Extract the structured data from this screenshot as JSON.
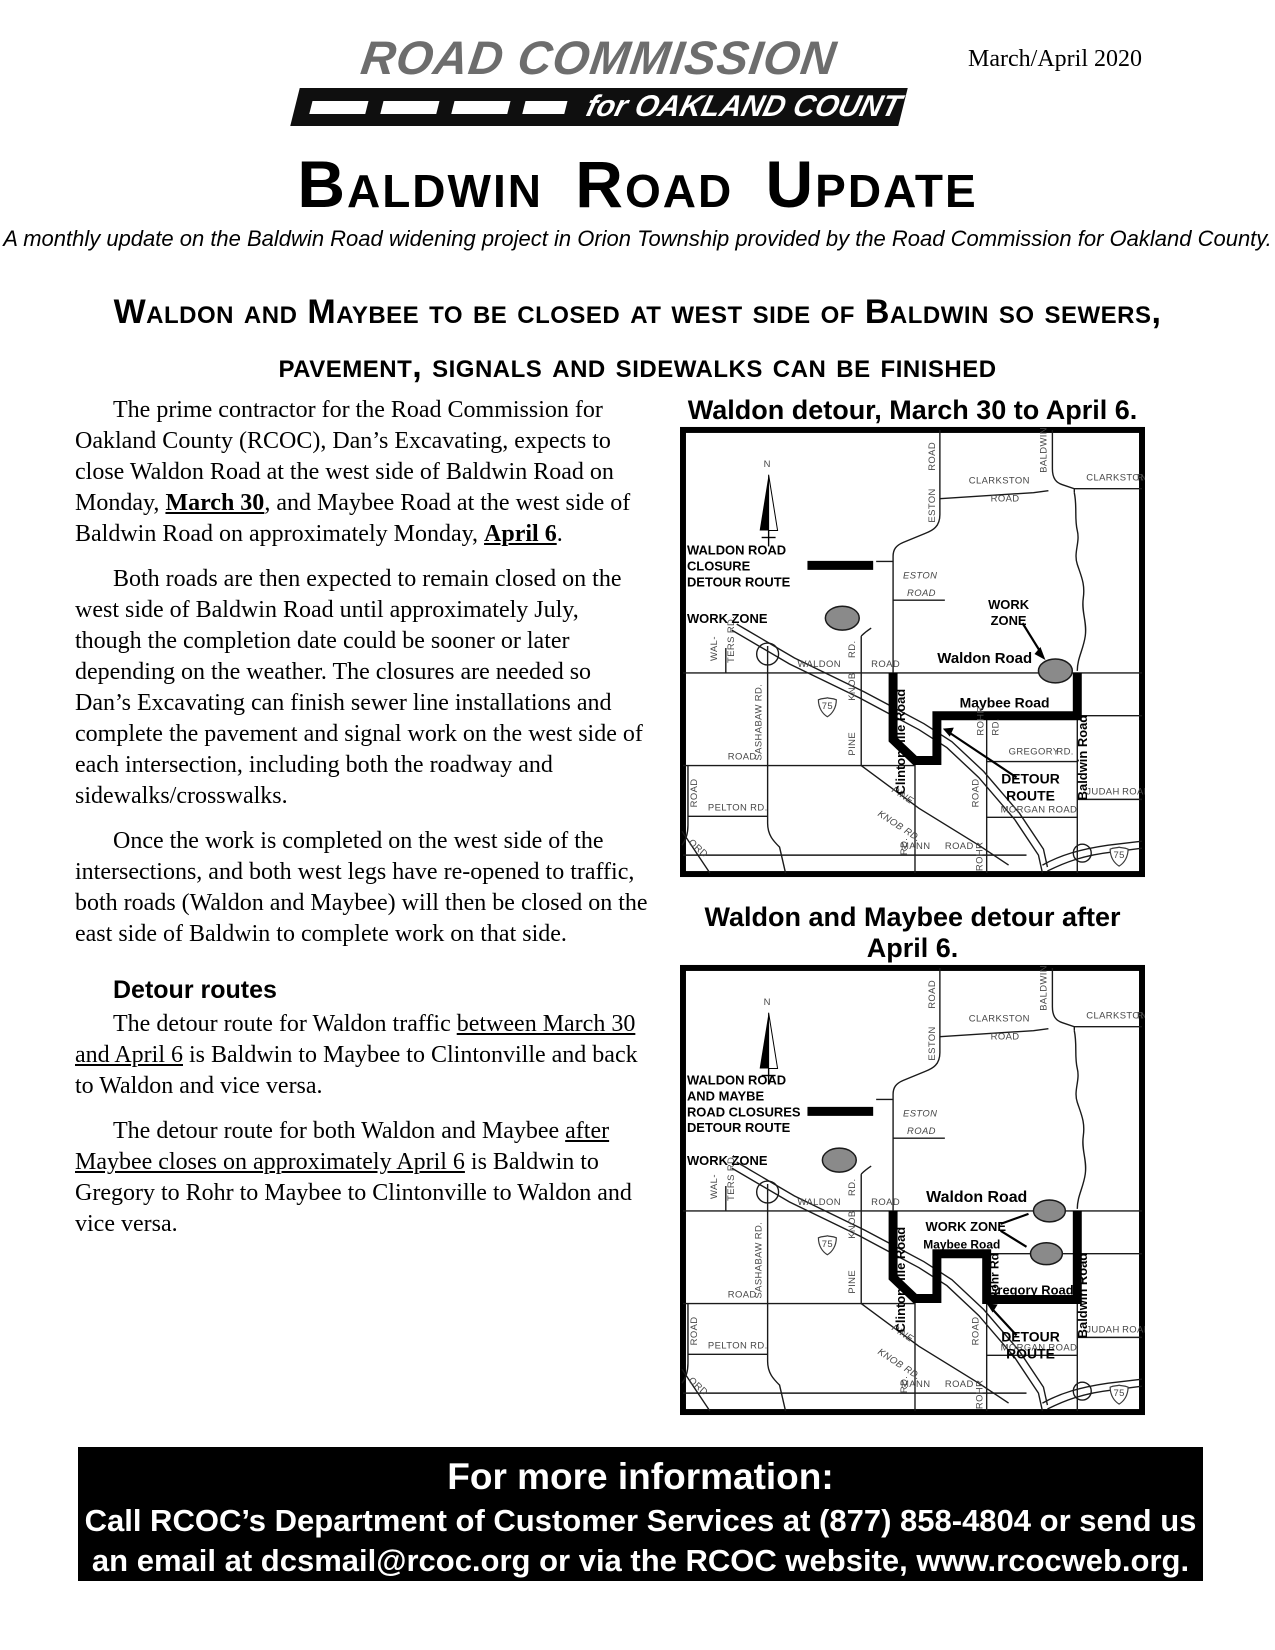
{
  "issue_date": "March/April 2020",
  "logo": {
    "line1": "ROAD COMMISSION",
    "line2": "for OAKLAND COUNTY"
  },
  "title": "Baldwin Road Update",
  "subtitle": "A monthly update on the Baldwin Road widening project in Orion Township provided by the Road Commission for Oakland County.",
  "headline": "Waldon and Maybee to be closed at west side of Baldwin so sewers, pavement, signals and sidewalks can be finished",
  "article": {
    "p1": {
      "pre": "The prime contractor for the Road Commission for Oakland County (RCOC), Dan’s Excavating, expects to close Waldon Road at the west side of Baldwin Road on Monday, ",
      "b1": "March 30",
      "mid": ", and Maybee Road at the west side of Baldwin Road on approximately Monday, ",
      "b2": "April 6",
      "post": "."
    },
    "p2": "Both roads are then expected to remain closed on the west side of Baldwin Road until approximately July, though the completion date could be sooner or later depending on the weather. The closures are needed so Dan’s Excavating can finish sewer line installations and complete the pavement and signal work on the west side of each intersection, including both the roadway and sidewalks/crosswalks.",
    "p3": "Once the work is completed on the west side of the intersections, and both west legs have re-opened to traffic, both roads (Waldon and Maybee) will then be closed on the east side of Baldwin to complete work on that side.",
    "detour_heading": "Detour routes",
    "p4": {
      "pre": "The detour route for Waldon traffic ",
      "u": "between March 30 and April 6",
      "post": " is Baldwin to Maybee to Clintonville and back to Waldon and vice versa."
    },
    "p5": {
      "pre": "The detour route for both Waldon and Maybee ",
      "u": "after Maybee closes on approximately April 6",
      "post": " is Baldwin to Gregory to Rohr to Maybee to Clintonville to Waldon and vice versa."
    }
  },
  "maps": [
    {
      "caption": "Waldon detour, March 30 to April 6.",
      "legend": [
        "WALDON ROAD",
        "CLOSURE",
        "DETOUR ROUTE"
      ],
      "legend_work_zone": "WORK ZONE",
      "work": "WORK",
      "zone": "ZONE",
      "waldon_bold": "Waldon Road",
      "maybee_bold": "Maybee Road",
      "clintonville_bold": "Clintonville Road",
      "baldwin_bold": "Baldwin Road",
      "detour": "DETOUR",
      "route": "ROUTE"
    },
    {
      "caption": "Waldon and Maybee detour after April 6.",
      "legend": [
        "WALDON ROAD",
        "AND MAYBE",
        "ROAD CLOSURES",
        "DETOUR ROUTE"
      ],
      "legend_work_zone": "WORK ZONE",
      "work_zone": "WORK ZONE",
      "waldon_bold": "Waldon Road",
      "maybee_bold": "Maybee Road",
      "clintonville_bold": "Clintonville Road",
      "baldwin_bold": "Baldwin Road",
      "rohr_bold": "Rohr Rd",
      "gregory_bold": "Gregory Road",
      "detour": "DETOUR",
      "route": "ROUTE"
    }
  ],
  "map_base": {
    "north": "N",
    "clarkston": "CLARKSTON",
    "road": "ROAD",
    "baldwin": "BALDWIN",
    "eston": "ESTON",
    "waldon": "WALDON",
    "walters1": "WAL-",
    "walters2": "TERS RD.",
    "sashabaw": "SASHABAW RD.",
    "i75": "75",
    "rd": "RD.",
    "knob": "KNOB",
    "pine": "PINE",
    "knob_rd": "KNOB RD.",
    "pelton": "PELTON RD.",
    "ord": "ORD",
    "mann": "MANN",
    "morgan": "MORGAN",
    "judah": "JUDAH",
    "rohr": "ROHR",
    "gregory": "GREGORY"
  },
  "footer": {
    "line1": "For more information:",
    "line2": "Call RCOC’s Department of Customer Services at (877) 858-4804 or send us",
    "line3": "an email at dcsmail@rcoc.org or via the RCOC website, www.rcocweb.org."
  }
}
